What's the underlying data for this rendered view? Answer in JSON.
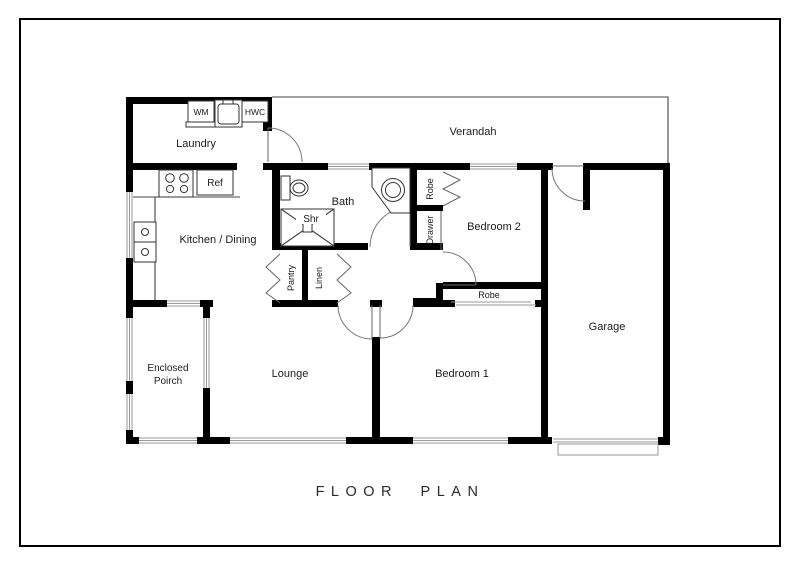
{
  "page": {
    "title": "FLOOR PLAN"
  },
  "rooms": {
    "laundry": {
      "label": "Laundry"
    },
    "verandah": {
      "label": "Verandah"
    },
    "kitchen_dining": {
      "label": "Kitchen / Dining"
    },
    "bath": {
      "label": "Bath"
    },
    "bedroom2": {
      "label": "Bedroom 2"
    },
    "garage": {
      "label": "Garage"
    },
    "enclosed_porch": {
      "label_line1": "Enclosed",
      "label_line2": "Poirch"
    },
    "lounge": {
      "label": "Lounge"
    },
    "bedroom1": {
      "label": "Bedroom 1"
    }
  },
  "fixtures": {
    "washing_machine": "WM",
    "hot_water_cylinder": "HWC",
    "refrigerator": "Ref",
    "shower": "Shr",
    "robe_bedroom2": "Robe",
    "drawer": "Drawer",
    "pantry": "Pantry",
    "linen": "Linen",
    "robe_bedroom1": "Robe"
  },
  "colors": {
    "wall": "#000000",
    "window_line": "#9a9a9a",
    "door_arc": "#777777",
    "background": "#ffffff",
    "text": "#1c1c1c"
  }
}
